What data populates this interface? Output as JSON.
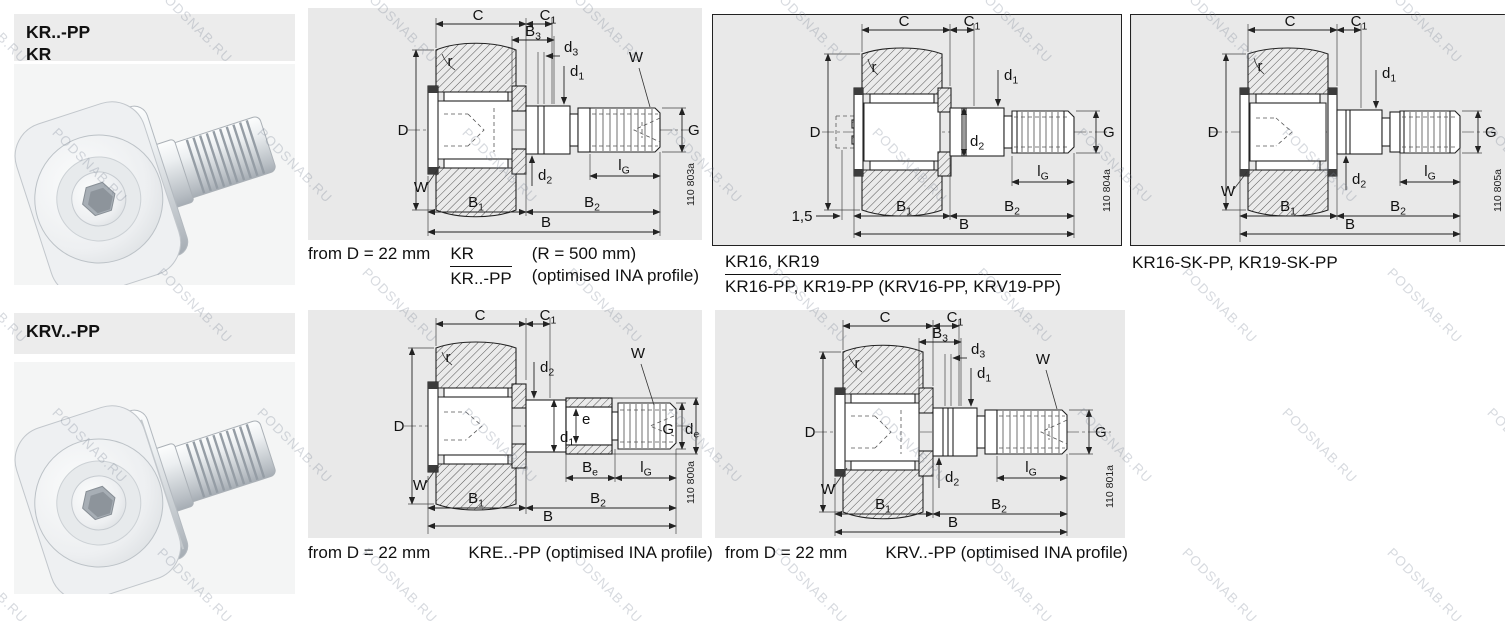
{
  "watermark": {
    "text": "PODSNAB.RU"
  },
  "sections": {
    "kr": {
      "line1": "KR..-PP",
      "line2": "KR"
    },
    "krv": {
      "line1": "KRV..-PP"
    }
  },
  "captions": {
    "kr": {
      "prefix": "from D = 22 mm",
      "frac_top": "KR",
      "frac_bottom": "KR..-PP",
      "note_top": "(R = 500 mm)",
      "note_bottom": "(optimised INA profile)"
    },
    "kr16": {
      "frac_top": "KR16, KR19",
      "frac_bottom": "KR16-PP, KR19-PP (KRV16-PP, KRV19-PP)"
    },
    "kr16sk": {
      "text": "KR16-SK-PP, KR19-SK-PP"
    },
    "kre": {
      "prefix": "from D = 22 mm",
      "text": "KRE..-PP (optimised INA profile)"
    },
    "krv": {
      "prefix": "from D = 22 mm",
      "text": "KRV..-PP (optimised INA profile)"
    }
  },
  "drawings": {
    "kr": {
      "figure_number": "110 803a",
      "dims": {
        "C": {
          "m": "C",
          "s": ""
        },
        "C1": {
          "m": "C",
          "s": "1"
        },
        "B3": {
          "m": "B",
          "s": "3"
        },
        "d3": {
          "m": "d",
          "s": "3"
        },
        "d1": {
          "m": "d",
          "s": "1"
        },
        "W_top": {
          "m": "W",
          "s": ""
        },
        "r": {
          "m": "r",
          "s": ""
        },
        "D": {
          "m": "D",
          "s": ""
        },
        "G": {
          "m": "G",
          "s": ""
        },
        "W_bottom": {
          "m": "W",
          "s": ""
        },
        "d2": {
          "m": "d",
          "s": "2"
        },
        "lG": {
          "m": "l",
          "s": "G"
        },
        "B1": {
          "m": "B",
          "s": "1"
        },
        "B2": {
          "m": "B",
          "s": "2"
        },
        "B": {
          "m": "B",
          "s": ""
        }
      }
    },
    "kr16": {
      "figure_number": "110 804a",
      "dims": {
        "C": {
          "m": "C",
          "s": ""
        },
        "C1": {
          "m": "C",
          "s": "1"
        },
        "r": {
          "m": "r",
          "s": ""
        },
        "d1": {
          "m": "d",
          "s": "1"
        },
        "D": {
          "m": "D",
          "s": ""
        },
        "G": {
          "m": "G",
          "s": ""
        },
        "d2": {
          "m": "d",
          "s": "2"
        },
        "lG": {
          "m": "l",
          "s": "G"
        },
        "recess_depth": {
          "m": "1,5",
          "s": ""
        },
        "B1": {
          "m": "B",
          "s": "1"
        },
        "B2": {
          "m": "B",
          "s": "2"
        },
        "B": {
          "m": "B",
          "s": ""
        }
      }
    },
    "kr16sk": {
      "figure_number": "110 805a",
      "dims": {
        "C": {
          "m": "C",
          "s": ""
        },
        "C1": {
          "m": "C",
          "s": "1"
        },
        "r": {
          "m": "r",
          "s": ""
        },
        "d1": {
          "m": "d",
          "s": "1"
        },
        "D": {
          "m": "D",
          "s": ""
        },
        "G": {
          "m": "G",
          "s": ""
        },
        "W_bottom": {
          "m": "W",
          "s": ""
        },
        "d2": {
          "m": "d",
          "s": "2"
        },
        "lG": {
          "m": "l",
          "s": "G"
        },
        "B1": {
          "m": "B",
          "s": "1"
        },
        "B2": {
          "m": "B",
          "s": "2"
        },
        "B": {
          "m": "B",
          "s": ""
        }
      }
    },
    "kre": {
      "figure_number": "110 800a",
      "dims": {
        "C": {
          "m": "C",
          "s": ""
        },
        "C1": {
          "m": "C",
          "s": "1"
        },
        "r": {
          "m": "r",
          "s": ""
        },
        "d2": {
          "m": "d",
          "s": "2"
        },
        "e": {
          "m": "e",
          "s": ""
        },
        "W_top": {
          "m": "W",
          "s": ""
        },
        "D": {
          "m": "D",
          "s": ""
        },
        "d1": {
          "m": "d",
          "s": "1"
        },
        "G": {
          "m": "G",
          "s": ""
        },
        "de": {
          "m": "d",
          "s": "e"
        },
        "W_bottom": {
          "m": "W",
          "s": ""
        },
        "Be": {
          "m": "B",
          "s": "e"
        },
        "lG": {
          "m": "l",
          "s": "G"
        },
        "B1": {
          "m": "B",
          "s": "1"
        },
        "B2": {
          "m": "B",
          "s": "2"
        },
        "B": {
          "m": "B",
          "s": ""
        }
      }
    },
    "krv": {
      "figure_number": "110 801a",
      "dims": {
        "C": {
          "m": "C",
          "s": ""
        },
        "C1": {
          "m": "C",
          "s": "1"
        },
        "B3": {
          "m": "B",
          "s": "3"
        },
        "d3": {
          "m": "d",
          "s": "3"
        },
        "d1": {
          "m": "d",
          "s": "1"
        },
        "W_top": {
          "m": "W",
          "s": ""
        },
        "r": {
          "m": "r",
          "s": ""
        },
        "D": {
          "m": "D",
          "s": ""
        },
        "G": {
          "m": "G",
          "s": ""
        },
        "W_bottom": {
          "m": "W",
          "s": ""
        },
        "d2": {
          "m": "d",
          "s": "2"
        },
        "lG": {
          "m": "l",
          "s": "G"
        },
        "B1": {
          "m": "B",
          "s": "1"
        },
        "B2": {
          "m": "B",
          "s": "2"
        },
        "B": {
          "m": "B",
          "s": ""
        }
      }
    }
  }
}
